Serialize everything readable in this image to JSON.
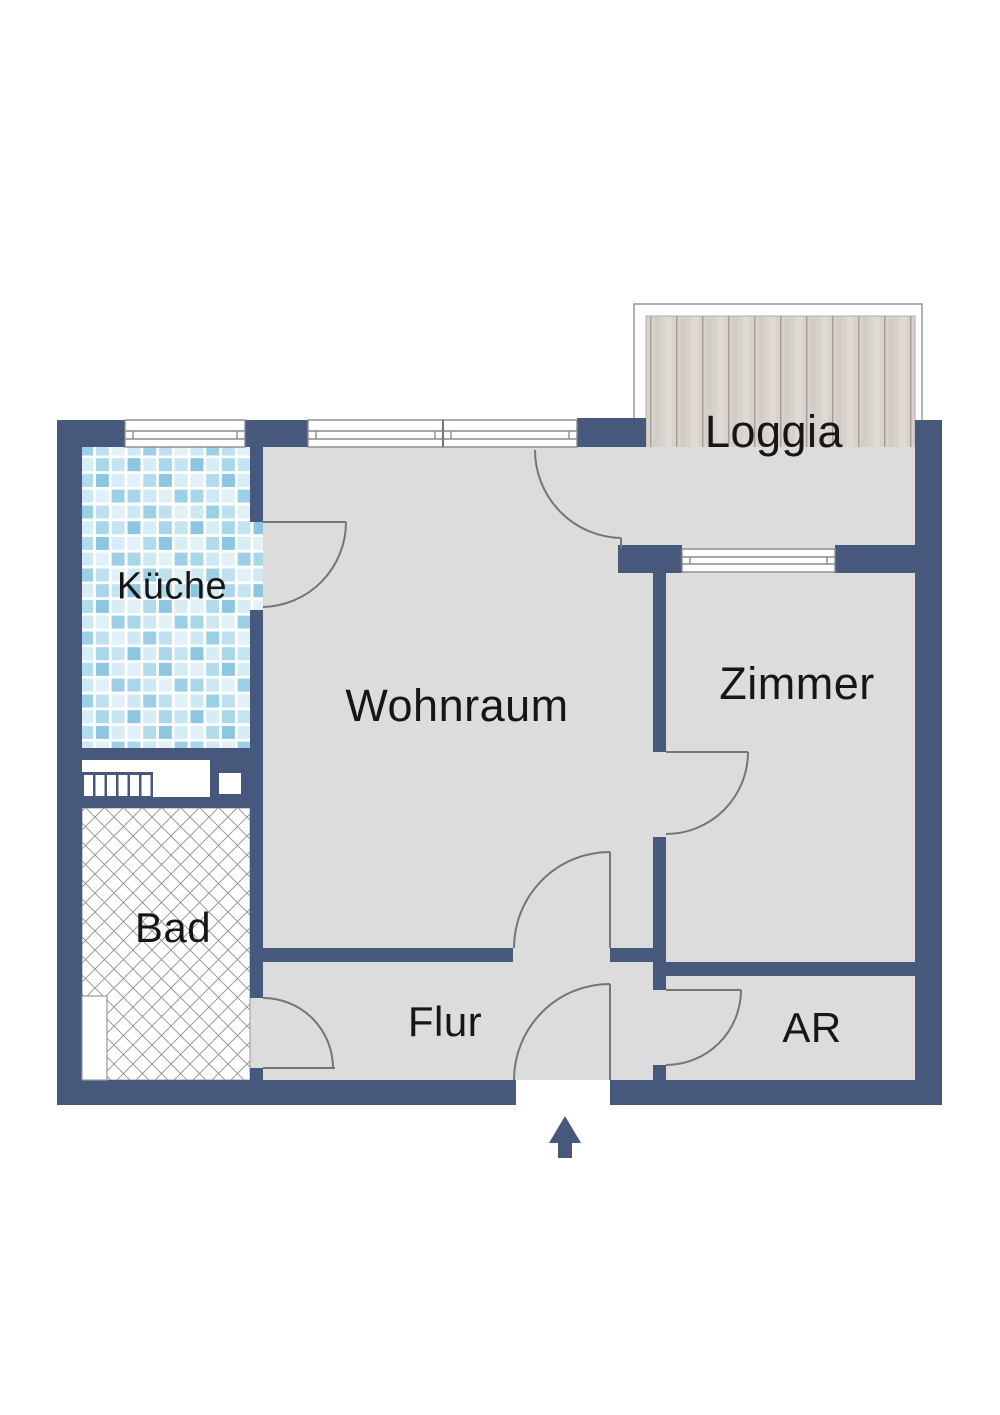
{
  "floorplan": {
    "title": "apartment-floor-plan",
    "rooms": [
      {
        "id": "kueche",
        "label": "Küche"
      },
      {
        "id": "wohnraum",
        "label": "Wohnraum"
      },
      {
        "id": "loggia",
        "label": "Loggia"
      },
      {
        "id": "zimmer",
        "label": "Zimmer"
      },
      {
        "id": "bad",
        "label": "Bad"
      },
      {
        "id": "flur",
        "label": "Flur"
      },
      {
        "id": "ar",
        "label": "AR"
      }
    ],
    "icons": [
      {
        "name": "entrance-arrow",
        "shape": "up-arrow"
      }
    ],
    "colors": {
      "wall": "#46587c",
      "room_fill": "#dcdcdc",
      "door_stroke": "#757575",
      "window_stroke": "#8a8a8a",
      "bad_hatch": "#909090",
      "wood_base": "#d8d2cc",
      "tile_blue_light": "#cfe9f4",
      "tile_blue_medium": "#9cd0e6",
      "tile_blue_dark": "#8cc6e0",
      "tile_blue_pale": "#e2f1f8"
    }
  }
}
